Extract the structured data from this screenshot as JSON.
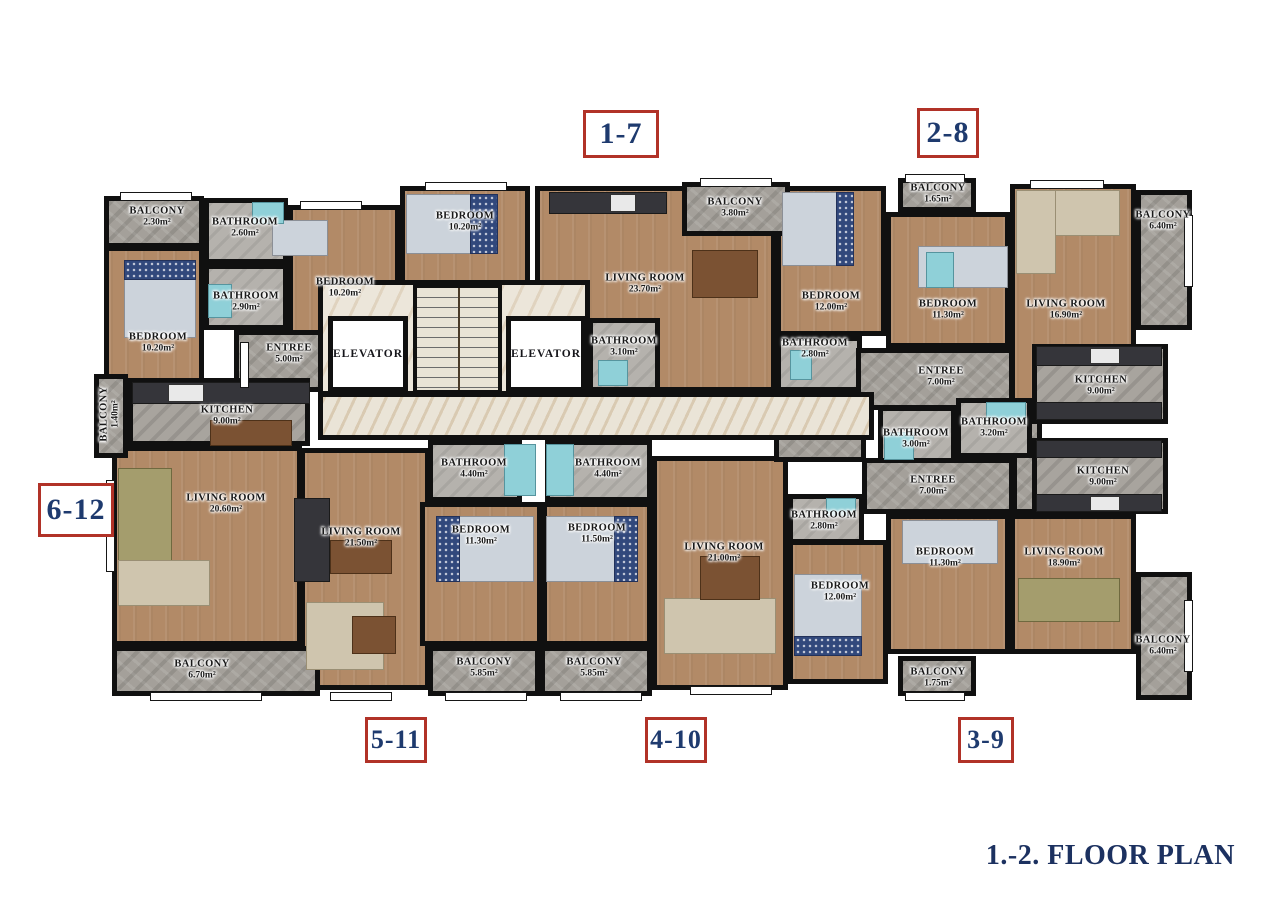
{
  "title": "1.-2. FLOOR PLAN",
  "unit_labels": [
    {
      "label": "1-7",
      "rect": [
        583,
        110,
        76,
        48
      ],
      "font": 30
    },
    {
      "label": "2-8",
      "rect": [
        917,
        108,
        62,
        50
      ],
      "font": 30
    },
    {
      "label": "6-12",
      "rect": [
        38,
        483,
        76,
        54
      ],
      "font": 30
    },
    {
      "label": "5-11",
      "rect": [
        365,
        717,
        62,
        46
      ],
      "font": 26
    },
    {
      "label": "4-10",
      "rect": [
        645,
        717,
        62,
        46
      ],
      "font": 26
    },
    {
      "label": "3-9",
      "rect": [
        958,
        717,
        56,
        46
      ],
      "font": 26
    }
  ],
  "elevators": [
    {
      "label": "ELEVATOR",
      "rect": [
        328,
        316,
        80,
        76
      ]
    },
    {
      "label": "ELEVATOR",
      "rect": [
        506,
        316,
        80,
        76
      ]
    }
  ],
  "rooms": [
    {
      "name": "BEDROOM",
      "area": "10.20m²",
      "type": "wood",
      "rect": [
        104,
        246,
        100,
        144
      ],
      "label": [
        158,
        343
      ]
    },
    {
      "name": "BEDROOM",
      "area": "10.20m²",
      "type": "wood",
      "rect": [
        288,
        205,
        112,
        135
      ],
      "label": [
        345,
        288
      ]
    },
    {
      "name": "BEDROOM",
      "area": "10.20m²",
      "type": "wood",
      "rect": [
        400,
        186,
        130,
        100
      ],
      "label": [
        465,
        222
      ]
    },
    {
      "name": "LIVING ROOM",
      "area": "23.70m²",
      "type": "wood",
      "rect": [
        535,
        186,
        241,
        206
      ],
      "label": [
        645,
        284
      ]
    },
    {
      "name": "BEDROOM",
      "area": "12.00m²",
      "type": "wood",
      "rect": [
        776,
        186,
        110,
        150
      ],
      "label": [
        831,
        302
      ]
    },
    {
      "name": "BEDROOM",
      "area": "11.30m²",
      "type": "wood",
      "rect": [
        886,
        212,
        124,
        136
      ],
      "label": [
        948,
        310
      ]
    },
    {
      "name": "LIVING ROOM",
      "area": "16.90m²",
      "type": "wood",
      "rect": [
        1010,
        184,
        126,
        234
      ],
      "label": [
        1066,
        310
      ]
    },
    {
      "name": "LIVING ROOM",
      "area": "20.60m²",
      "type": "wood",
      "rect": [
        112,
        446,
        190,
        200
      ],
      "label": [
        226,
        504
      ]
    },
    {
      "name": "LIVING ROOM",
      "area": "21.50m²",
      "type": "wood",
      "rect": [
        300,
        448,
        130,
        242
      ],
      "label": [
        361,
        538
      ]
    },
    {
      "name": "BEDROOM",
      "area": "11.30m²",
      "type": "wood",
      "rect": [
        420,
        502,
        122,
        144
      ],
      "label": [
        481,
        536
      ]
    },
    {
      "name": "BEDROOM",
      "area": "11.50m²",
      "type": "wood",
      "rect": [
        542,
        502,
        110,
        144
      ],
      "label": [
        597,
        534
      ]
    },
    {
      "name": "LIVING ROOM",
      "area": "21.00m²",
      "type": "wood",
      "rect": [
        652,
        456,
        136,
        234
      ],
      "label": [
        724,
        553
      ]
    },
    {
      "name": "BEDROOM",
      "area": "12.00m²",
      "type": "wood",
      "rect": [
        788,
        540,
        100,
        144
      ],
      "label": [
        840,
        592
      ]
    },
    {
      "name": "BEDROOM",
      "area": "11.30m²",
      "type": "wood",
      "rect": [
        886,
        514,
        124,
        140
      ],
      "label": [
        945,
        558
      ]
    },
    {
      "name": "LIVING ROOM",
      "area": "18.90m²",
      "type": "wood",
      "rect": [
        1010,
        514,
        126,
        140
      ],
      "label": [
        1064,
        558
      ]
    },
    {
      "name": "BALCONY",
      "area": "2.30m²",
      "type": "stone",
      "rect": [
        104,
        196,
        100,
        52
      ],
      "label": [
        157,
        217
      ]
    },
    {
      "name": "BATHROOM",
      "area": "2.60m²",
      "type": "bath",
      "rect": [
        204,
        198,
        84,
        66
      ],
      "label": [
        245,
        228
      ]
    },
    {
      "name": "BATHROOM",
      "area": "2.90m²",
      "type": "bath",
      "rect": [
        204,
        264,
        84,
        66
      ],
      "label": [
        246,
        302
      ]
    },
    {
      "name": "ENTREE",
      "area": "5.00m²",
      "type": "stone",
      "rect": [
        234,
        330,
        96,
        62
      ],
      "label": [
        289,
        354
      ]
    },
    {
      "name": "KITCHEN",
      "area": "9.00m²",
      "type": "kitchen",
      "rect": [
        128,
        378,
        182,
        68
      ],
      "label": [
        227,
        416
      ]
    },
    {
      "name": "BALCONY",
      "area": "1.40m²",
      "type": "stone",
      "rect": [
        94,
        374,
        34,
        84
      ],
      "label": [
        110,
        414
      ],
      "vertical": true
    },
    {
      "name": "BALCONY",
      "area": "6.70m²",
      "type": "stone",
      "rect": [
        112,
        646,
        208,
        50
      ],
      "label": [
        202,
        670
      ]
    },
    {
      "name": "BATHROOM",
      "area": "3.10m²",
      "type": "bath",
      "rect": [
        588,
        318,
        72,
        74
      ],
      "label": [
        624,
        347
      ]
    },
    {
      "name": "BALCONY",
      "area": "3.80m²",
      "type": "stone",
      "rect": [
        682,
        182,
        108,
        54
      ],
      "label": [
        735,
        208
      ]
    },
    {
      "name": "BATHROOM",
      "area": "2.80m²",
      "type": "bath",
      "rect": [
        776,
        336,
        86,
        56
      ],
      "label": [
        815,
        349
      ]
    },
    {
      "name": "BALCONY",
      "area": "1.65m²",
      "type": "stone",
      "rect": [
        898,
        178,
        78,
        34
      ],
      "label": [
        938,
        194
      ]
    },
    {
      "name": "ENTREE",
      "area": "7.00m²",
      "type": "stone",
      "rect": [
        856,
        348,
        158,
        62
      ],
      "label": [
        941,
        377
      ]
    },
    {
      "name": "BALCONY",
      "area": "6.40m²",
      "type": "stone",
      "rect": [
        1136,
        190,
        56,
        140
      ],
      "label": [
        1163,
        221
      ]
    },
    {
      "name": "",
      "area": "",
      "type": "stone",
      "rect": [
        774,
        392,
        92,
        70
      ]
    },
    {
      "name": "",
      "area": "",
      "type": "stone",
      "rect": [
        1012,
        410,
        30,
        104
      ]
    },
    {
      "name": "KITCHEN",
      "area": "9.00m²",
      "type": "kitchen",
      "rect": [
        1032,
        344,
        136,
        80
      ],
      "label": [
        1101,
        386
      ]
    },
    {
      "name": "BATHROOM",
      "area": "3.00m²",
      "type": "bath",
      "rect": [
        878,
        406,
        78,
        62
      ],
      "label": [
        916,
        439
      ]
    },
    {
      "name": "BATHROOM",
      "area": "3.20m²",
      "type": "bath",
      "rect": [
        956,
        398,
        76,
        60
      ],
      "label": [
        994,
        428
      ]
    },
    {
      "name": "ENTREE",
      "area": "7.00m²",
      "type": "stone",
      "rect": [
        862,
        458,
        152,
        56
      ],
      "label": [
        933,
        486
      ]
    },
    {
      "name": "KITCHEN",
      "area": "9.00m²",
      "type": "kitchen",
      "rect": [
        1032,
        438,
        136,
        76
      ],
      "label": [
        1103,
        477
      ]
    },
    {
      "name": "BATHROOM",
      "area": "4.40m²",
      "type": "bath",
      "rect": [
        428,
        440,
        94,
        62
      ],
      "label": [
        474,
        469
      ]
    },
    {
      "name": "BATHROOM",
      "area": "4.40m²",
      "type": "bath",
      "rect": [
        545,
        440,
        107,
        62
      ],
      "label": [
        608,
        469
      ]
    },
    {
      "name": "BATHROOM",
      "area": "2.80m²",
      "type": "bath",
      "rect": [
        788,
        494,
        76,
        50
      ],
      "label": [
        824,
        521
      ]
    },
    {
      "name": "BALCONY",
      "area": "5.85m²",
      "type": "stone",
      "rect": [
        428,
        646,
        112,
        50
      ],
      "label": [
        484,
        668
      ]
    },
    {
      "name": "BALCONY",
      "area": "5.85m²",
      "type": "stone",
      "rect": [
        540,
        646,
        112,
        50
      ],
      "label": [
        594,
        668
      ]
    },
    {
      "name": "BALCONY",
      "area": "1.75m²",
      "type": "stone",
      "rect": [
        898,
        656,
        78,
        40
      ],
      "label": [
        938,
        678
      ]
    },
    {
      "name": "BALCONY",
      "area": "6.40m²",
      "type": "stone",
      "rect": [
        1136,
        572,
        56,
        128
      ],
      "label": [
        1163,
        646
      ]
    },
    {
      "name": "BEDROOM",
      "area": "11.30m²",
      "type": "none",
      "rect": [
        0,
        0,
        0,
        0
      ]
    },
    {
      "name": "",
      "area": "",
      "type": "lobby",
      "rect": [
        318,
        280,
        272,
        116
      ]
    },
    {
      "name": "",
      "area": "",
      "type": "corridor",
      "rect": [
        318,
        392,
        556,
        48
      ]
    }
  ],
  "colors": {
    "wall": "#101010",
    "wood_floor": "#b28a67",
    "stone_floor": "#a4a09a",
    "corridor_floor": "#eae4d7",
    "unit_border_red": "#b13228",
    "unit_text_navy": "#1e3a6e",
    "title_navy": "#1c3160",
    "fixture_teal": "#8fd0d8"
  }
}
